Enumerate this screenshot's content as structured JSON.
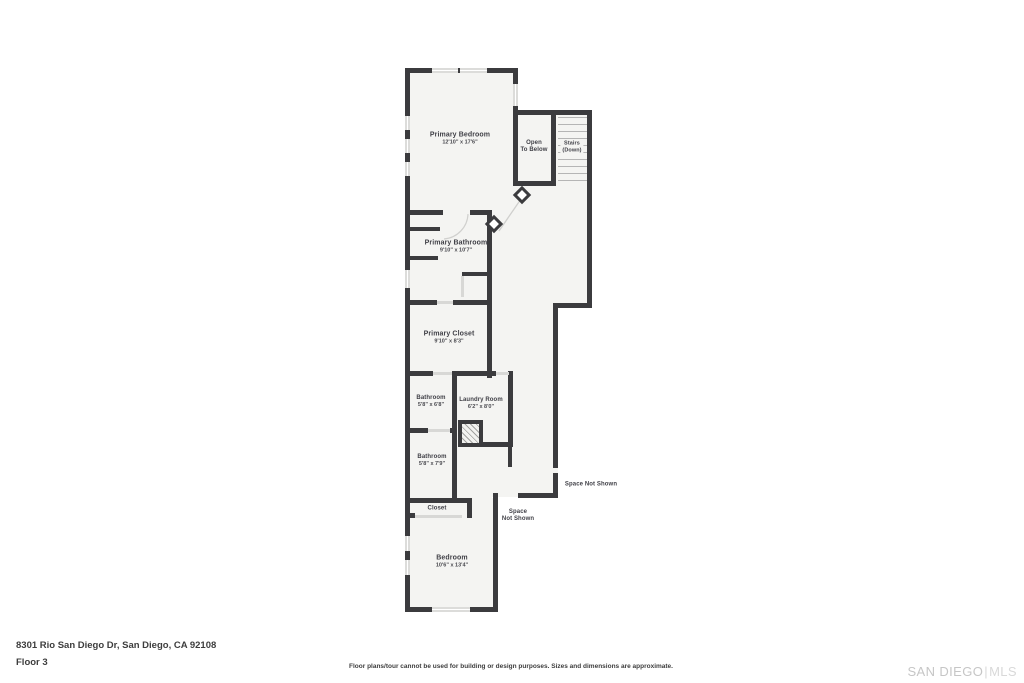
{
  "floor_plan": {
    "rooms": [
      {
        "id": "primary-bedroom",
        "name": "Primary Bedroom",
        "dims": "12'10\" x 17'6\""
      },
      {
        "id": "primary-bathroom",
        "name": "Primary Bathroom",
        "dims": "9'10\" x 10'7\""
      },
      {
        "id": "primary-closet",
        "name": "Primary Closet",
        "dims": "9'10\" x 8'3\""
      },
      {
        "id": "bathroom-upper",
        "name": "Bathroom",
        "dims": "5'8\" x 6'8\""
      },
      {
        "id": "laundry-room",
        "name": "Laundry Room",
        "dims": "6'2\" x 8'0\""
      },
      {
        "id": "bathroom-lower",
        "name": "Bathroom",
        "dims": "5'8\" x 7'9\""
      },
      {
        "id": "closet",
        "name": "Closet",
        "dims": ""
      },
      {
        "id": "bedroom",
        "name": "Bedroom",
        "dims": "10'6\" x 13'4\""
      }
    ],
    "annotations": {
      "open_to_below_line1": "Open",
      "open_to_below_line2": "To Below",
      "stairs_line1": "Stairs",
      "stairs_line2": "(Down)",
      "space_not_shown_right": "Space Not Shown",
      "space_not_shown_below_line1": "Space",
      "space_not_shown_below_line2": "Not Shown"
    }
  },
  "footer": {
    "address": "8301 Rio San Diego Dr, San Diego, CA 92108",
    "floor_label": "Floor 3",
    "disclaimer": "Floor plans/tour cannot be used for building or design purposes. Sizes and dimensions are approximate.",
    "watermark_primary": "SAN DIEGO",
    "watermark_divider": "|",
    "watermark_secondary": "MLS"
  },
  "colors": {
    "wall": "#3b3b3e",
    "room_fill": "#f4f4f2",
    "window_fill": "#dcdcda",
    "tread": "#b5b5b5",
    "label_text": "#3f3f46",
    "watermark": "#c6c6c6",
    "background": "#ffffff"
  }
}
